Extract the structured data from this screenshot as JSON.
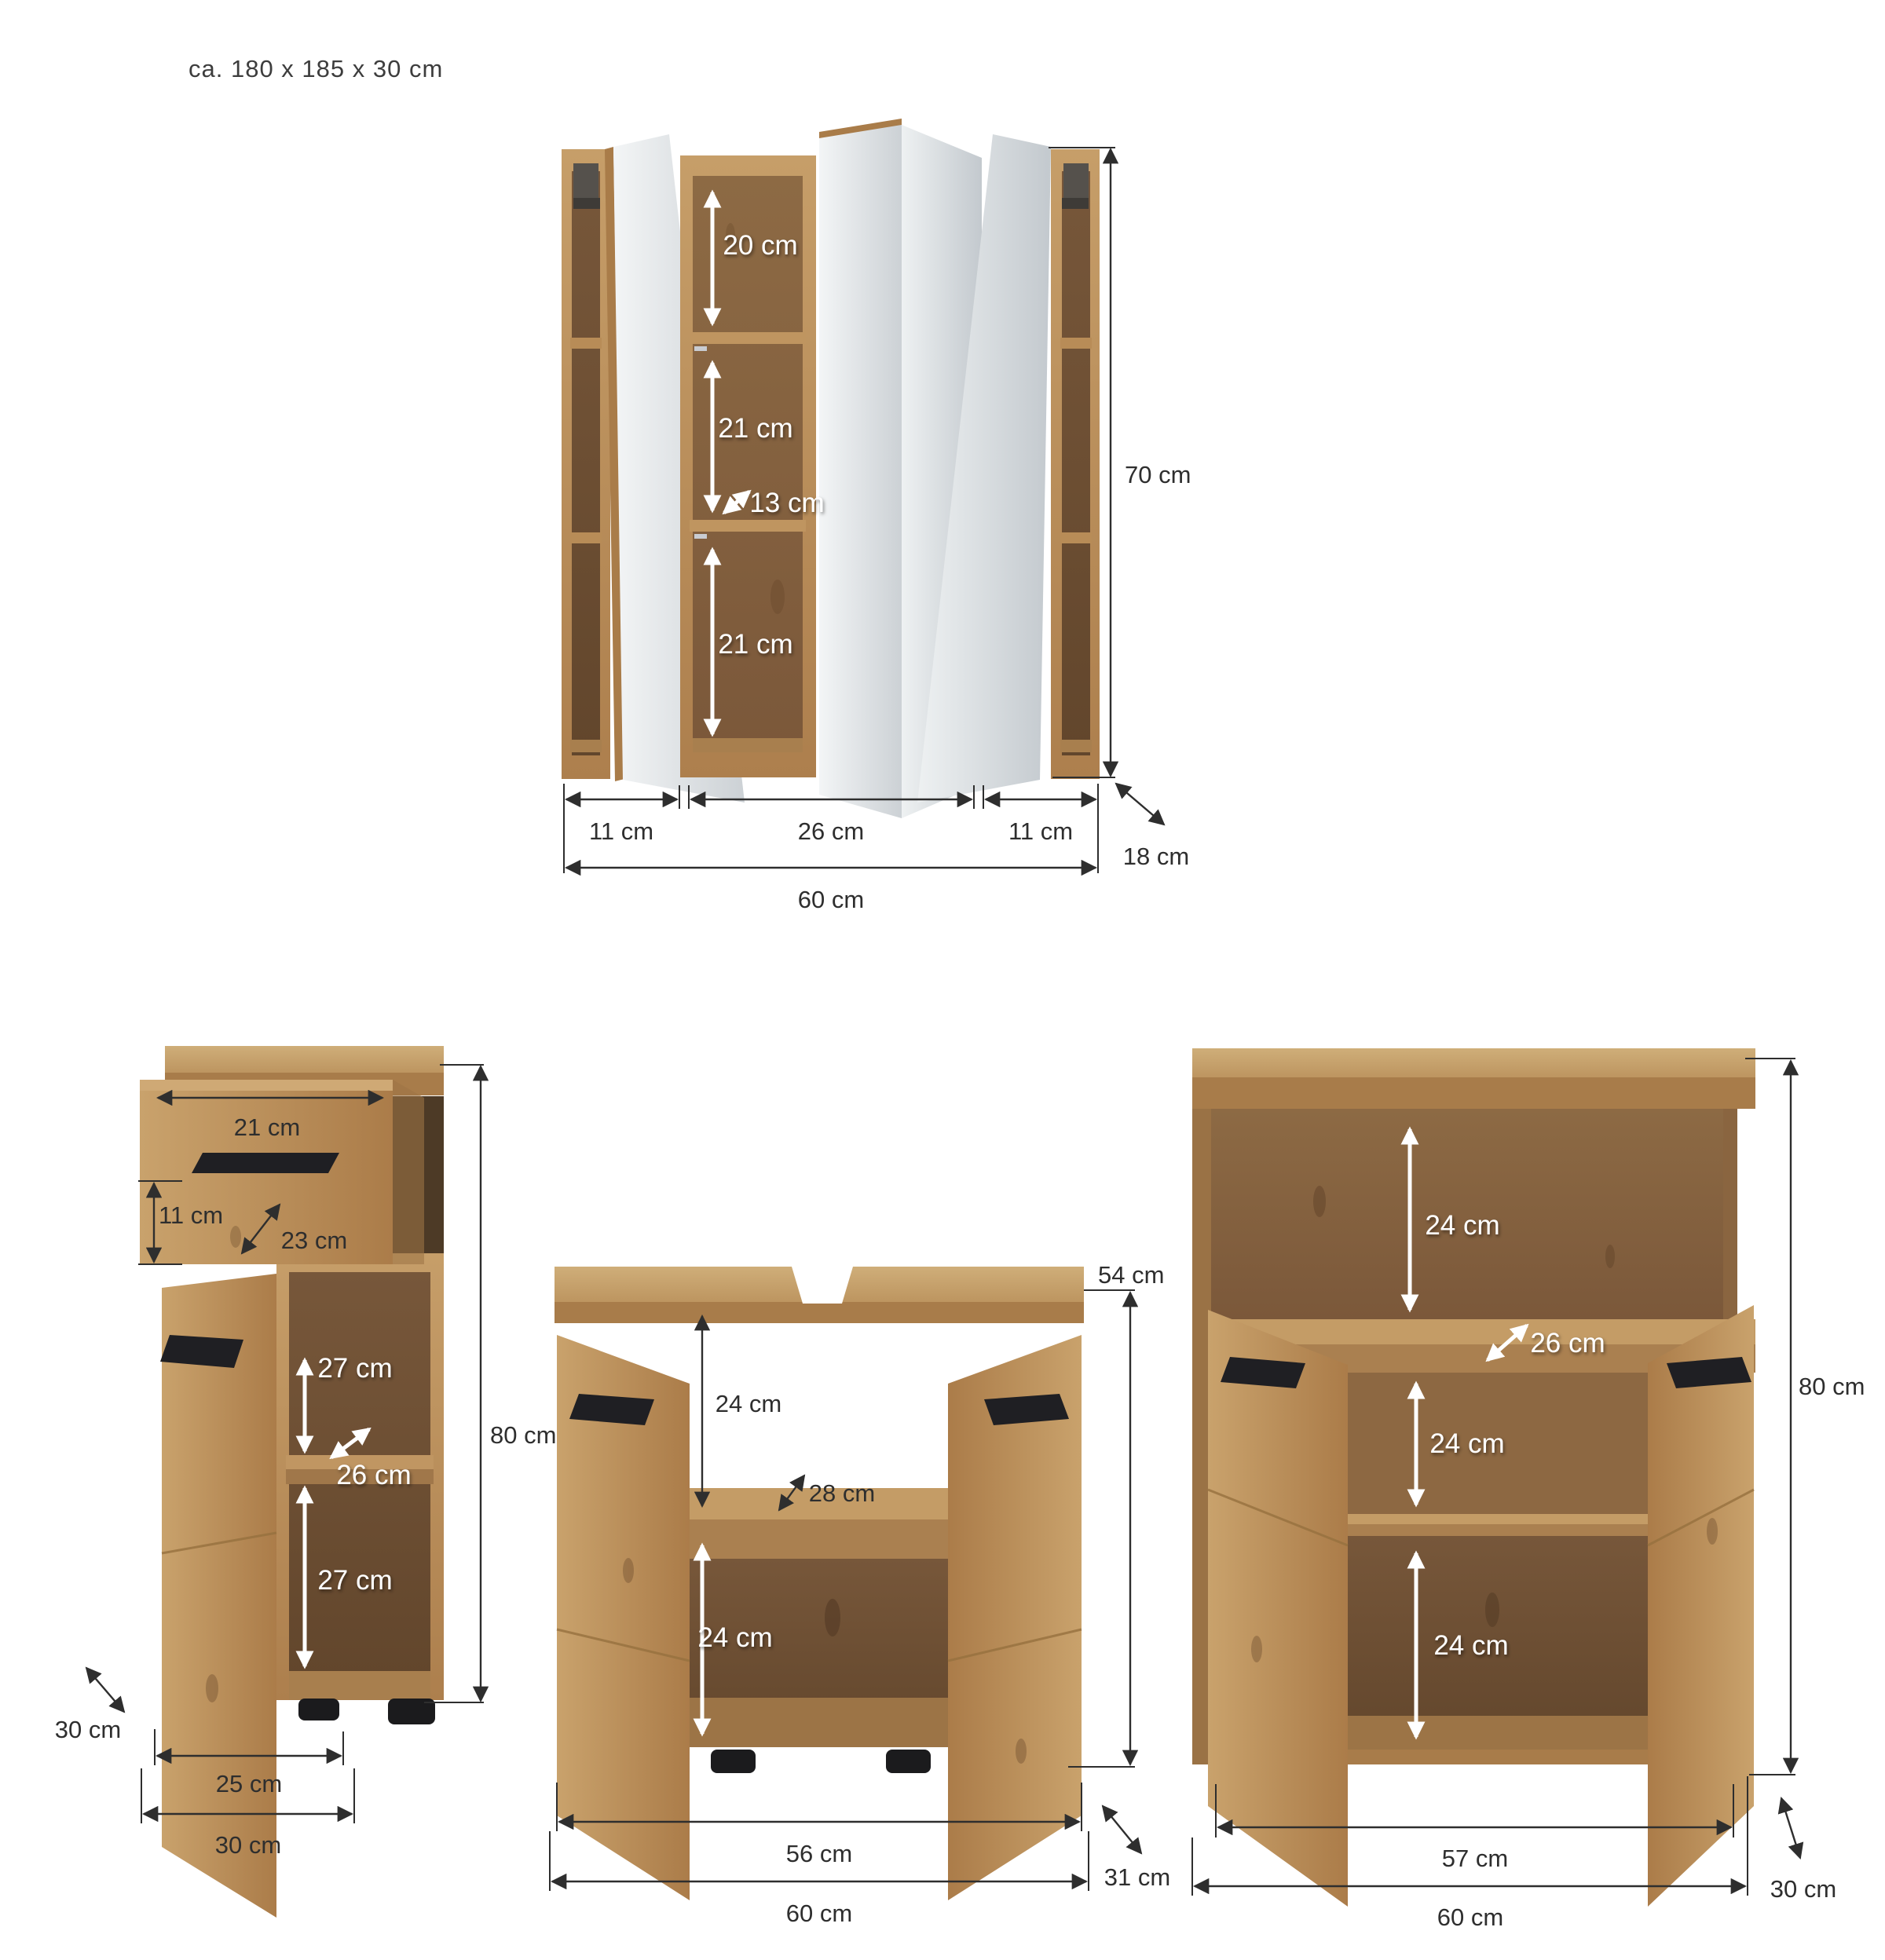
{
  "title": "ca. 180 x 185 x 30 cm",
  "mirror_cabinet": {
    "dims": {
      "top_compartment": "20 cm",
      "middle_compartment": "21 cm",
      "shelf_depth": "13 cm",
      "bottom_compartment": "21 cm",
      "height": "70 cm",
      "left_section_width": "11 cm",
      "center_section_width": "26 cm",
      "right_section_width": "11 cm",
      "total_width": "60 cm",
      "depth": "18 cm"
    }
  },
  "base_cabinet": {
    "dims": {
      "drawer_width": "21 cm",
      "drawer_front_height": "11 cm",
      "drawer_depth": "23 cm",
      "upper_compartment": "27 cm",
      "shelf_depth": "26 cm",
      "lower_compartment": "27 cm",
      "height": "80 cm",
      "depth": "30 cm",
      "door_width": "25 cm",
      "total_width": "30 cm"
    }
  },
  "sink_cabinet": {
    "dims": {
      "height": "54 cm",
      "upper_compartment": "24 cm",
      "shelf_depth": "28 cm",
      "lower_compartment": "24 cm",
      "inner_width": "56 cm",
      "total_width": "60 cm",
      "depth": "31 cm"
    }
  },
  "side_cabinet": {
    "dims": {
      "top_compartment": "24 cm",
      "shelf_depth": "26 cm",
      "middle_compartment": "24 cm",
      "bottom_compartment": "24 cm",
      "height": "80 cm",
      "inner_width": "57 cm",
      "total_width": "60 cm",
      "depth": "30 cm"
    }
  },
  "colors": {
    "wood_front": "#b98c58",
    "wood_interior": "#7a5a3a",
    "mirror": "#dfe3e6",
    "handle": "#1f1f23",
    "dimension_line": "#2e2e2e",
    "background": "#ffffff"
  }
}
